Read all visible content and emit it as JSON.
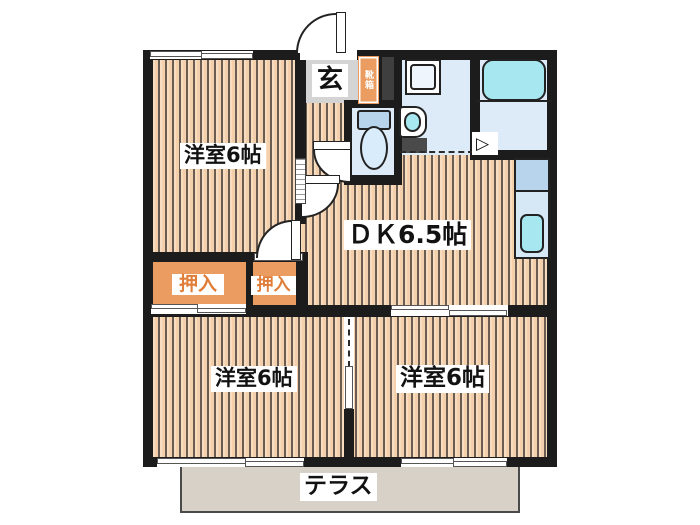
{
  "floorplan": {
    "labels": {
      "room_top_left": "洋室6帖",
      "dining_kitchen": "ＤＫ6.5帖",
      "room_bottom_left": "洋室6帖",
      "room_bottom_right": "洋室6帖",
      "entrance": "玄",
      "shoe_cabinet": "靴箱",
      "closet_left": "押入",
      "closet_right": "押入",
      "terrace": "テラス"
    },
    "icons": {
      "bath_folding_door": "▷"
    },
    "colors": {
      "wall": "#1c1c1c",
      "floor-base": "#f3d0ab",
      "floor-light": "#f8dcc0",
      "floor-stripe": "#6a5c50",
      "wet-floor": "#dcebf7",
      "wet-deep": "#b7d4ec",
      "fixture-cyan": "#a7e7f0",
      "closet-orange": "#eb9c61",
      "closet-text": "#e07d38",
      "genkan-gray": "#d4d4d4",
      "terrace-gray": "#d8d1c8"
    }
  }
}
